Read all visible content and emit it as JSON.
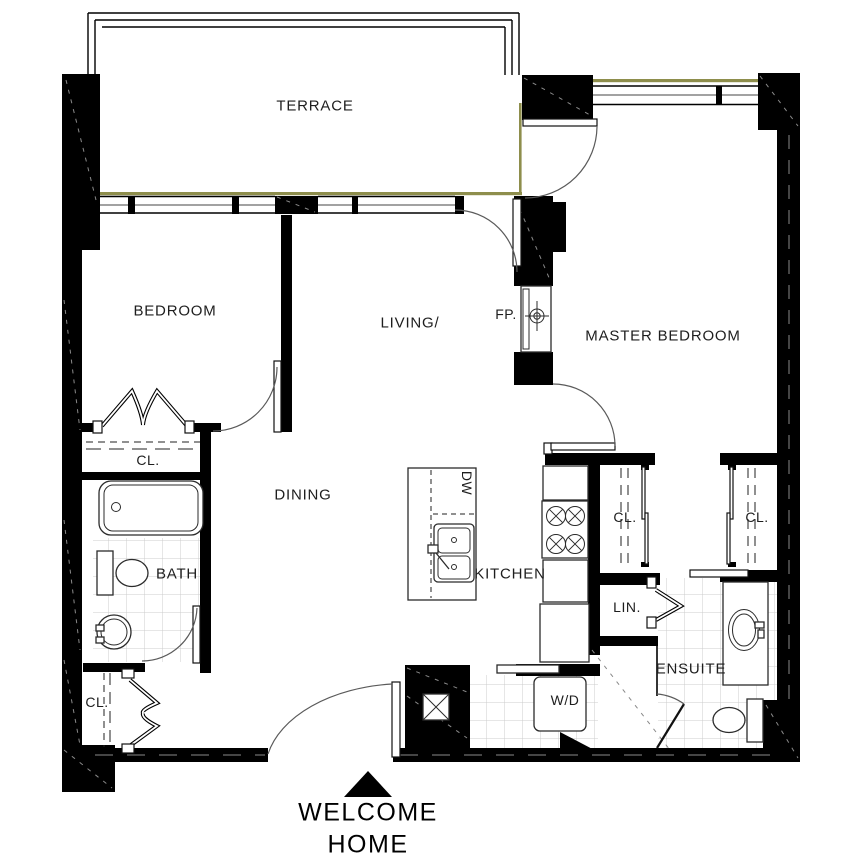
{
  "plan": {
    "labels": {
      "terrace": "TERRACE",
      "bedroom": "BEDROOM",
      "living": "LIVING/",
      "dining": "DINING",
      "master_bedroom": "MASTER BEDROOM",
      "kitchen": "KITCHEN",
      "bath": "BATH",
      "ensuite": "ENSUITE",
      "fireplace": "FP.",
      "dishwasher": "DW",
      "washer_dryer": "W/D",
      "linen": "LIN.",
      "closet_bedroom": "CL.",
      "closet_entry": "CL.",
      "closet_hall": "CL.",
      "closet_master": "CL."
    },
    "footer": {
      "line1": "WELCOME",
      "line2": "HOME"
    },
    "colors": {
      "wall": "#000000",
      "sill": "#8e8e4c",
      "line": "#3c3c3c",
      "tile": "#cccccc",
      "text": "#1e1e1e"
    }
  }
}
